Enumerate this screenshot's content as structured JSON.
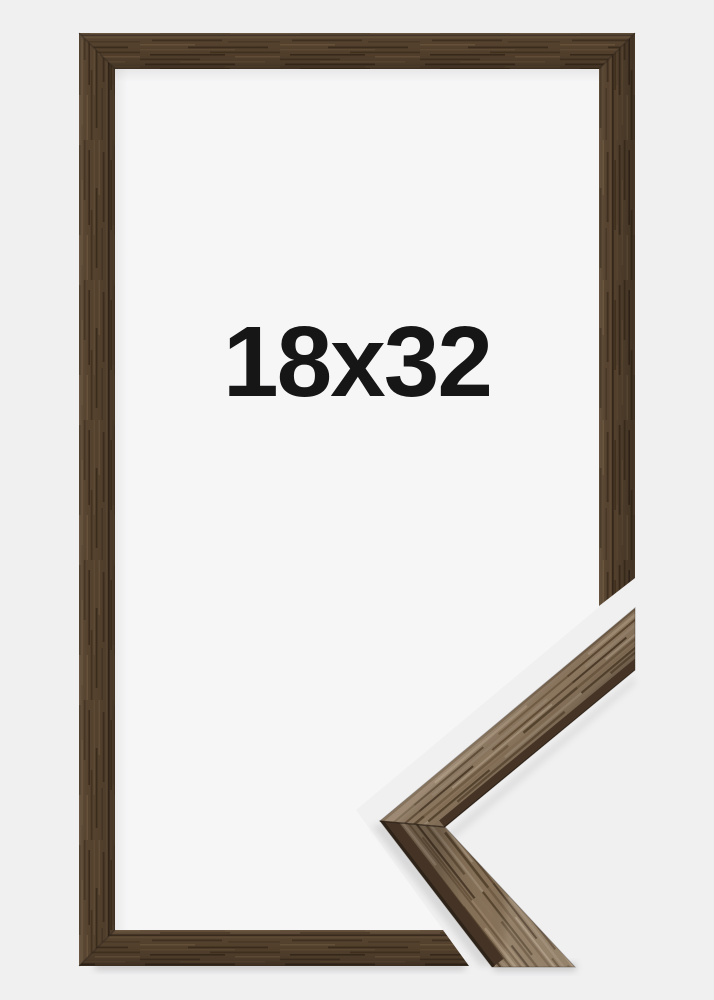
{
  "product": {
    "size_label": "18x32",
    "subject": "brown wooden picture frame with cut-away corner profile detail",
    "colors": {
      "background": "#f0f0f1",
      "mat_inside": "#f6f6f7",
      "frame_wood_base": "#55422e",
      "frame_wood_dark": "#3a2b1c",
      "frame_wood_light": "#6b5640",
      "detail_wood_base": "#8b765e",
      "detail_wood_dark": "#57452f",
      "detail_edge_dark": "#3b2d20",
      "label_text": "#161616"
    }
  }
}
